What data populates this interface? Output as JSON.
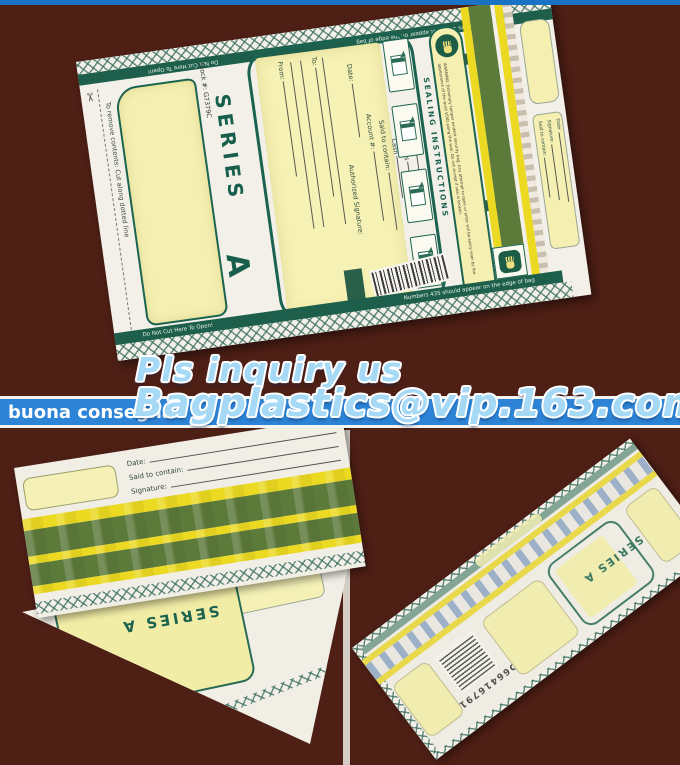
{
  "colors": {
    "background": "#4e1f15",
    "top_strip": "#1a72c4",
    "band_blue": "#2d84d6",
    "overlay_text_blue": "#a5d9f5",
    "print_green": "#1c6450",
    "tape_olive": "#5c7a3a",
    "tape_yellow": "#ecd921",
    "panel_yellow": "#f5f0b2"
  },
  "overlay": {
    "inquiry": "Pls inquiry us",
    "caption": "buona consegna",
    "email": "Bagplastics@vip.163.com"
  },
  "front_bag": {
    "top_strip_left": "Numbers 123 must appear on the edge of bag",
    "top_strip_right": "Do Not Cut Here To Open!",
    "cut_note": "To remove contents: Cut along dotted line",
    "stock": "Stock #: G7379C",
    "series_word": "SERIES",
    "series_letter": "A",
    "form": {
      "from": "From:",
      "to": "To:",
      "auth": "Authorized Signature:",
      "date": "Date:",
      "account": "Account #:",
      "contain": "Said to contain:",
      "cash": "Cash",
      "checks": "Checks",
      "other": "Other"
    },
    "sealing_title": "SEALING INSTRUCTIONS",
    "warning": "WARNING: Extremely tamper evident security bag. Any attempt to open or enter will be easily seen by the appearance of the word VOID along the seal. Do not accept if seal is broken.",
    "bottom_strip_left": "Do Not Cut Here To Open!",
    "bottom_strip_right": "Numbers 435 should appear on the edge of bag",
    "flap": {
      "contain": "Said to contain:",
      "signature": "Signature:",
      "date": "Date:"
    }
  },
  "folded_bag": {
    "date": "Date:",
    "contain": "Said to contain:",
    "signature": "Signature:",
    "series": "SERIES A"
  },
  "back_bag": {
    "barcode_number": "D66416791",
    "series": "SERIES A"
  }
}
